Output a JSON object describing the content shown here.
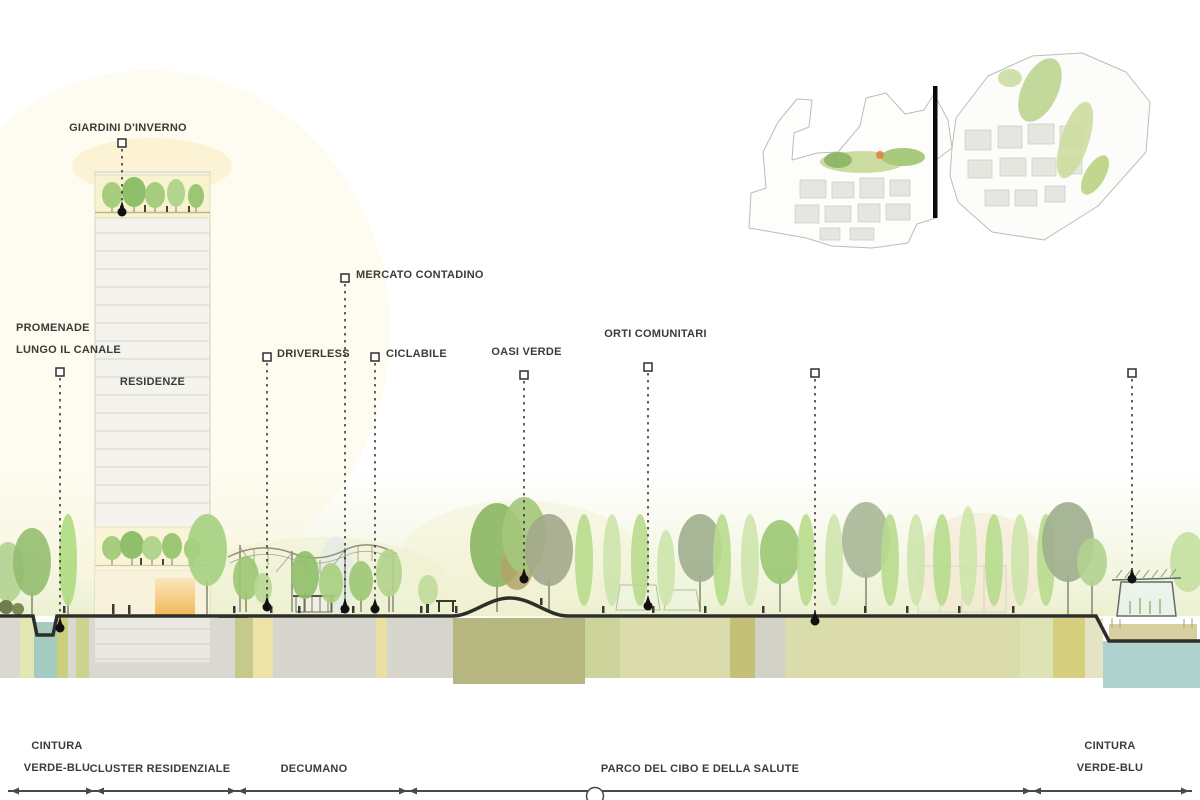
{
  "diagram_title": "Urban section diagram",
  "annotations": {
    "promenade": {
      "line1": "PROMENADE",
      "line2": "LUNGO IL CANALE"
    },
    "giardini": {
      "label": "GIARDINI D'INVERNO"
    },
    "mercato": {
      "label": "MERCATO CONTADINO"
    },
    "driverless": {
      "label": "DRIVERLESS"
    },
    "ciclabile": {
      "label": "CICLABILE"
    },
    "oasi": {
      "label": "OASI VERDE"
    },
    "orti": {
      "label": "ORTI COMUNITARI"
    }
  },
  "buildings": {
    "residenze": "RESIDENZE"
  },
  "zones": {
    "cintura_left": {
      "line1": "CINTURA",
      "line2": "VERDE-BLU"
    },
    "cluster_residenziale": "CLUSTER RESIDENZIALE",
    "decumano": "DECUMANO",
    "parco": "PARCO DEL CIBO E DELLA SALUTE",
    "cintura_right": {
      "line1": "CINTURA",
      "line2": "VERDE-BLU"
    }
  },
  "palette": {
    "ground_line": "#32322b",
    "water": "#a9cfc9",
    "underground_gray": "#d8d8d0",
    "underground_olive": "#b5b680",
    "underground_yellow": "#ecd98c",
    "tree_green": "#9cc673",
    "tree_light_green": "#c0dc9a",
    "tree_gray_green": "#a3a88b",
    "winter_garden_yellow": "#f8f3cf",
    "accent_orange": "#f2b95c",
    "label_text": "#3b3b38"
  }
}
